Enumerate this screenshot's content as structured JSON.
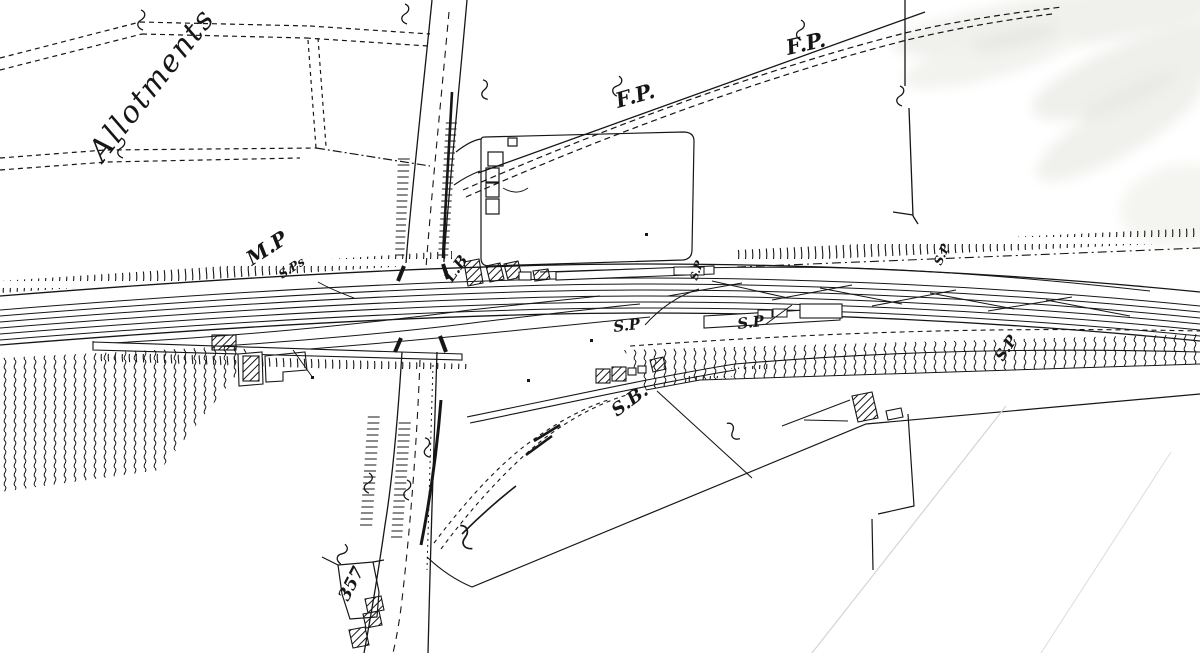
{
  "colors": {
    "ink": "#161616",
    "paper": "#ffffff",
    "faint_line": "#d4d4d0",
    "artifact_gray": "#ededea"
  },
  "labels": {
    "allotments": "Allotments",
    "footpath_west": "F.P.",
    "footpath_east": "F.P.",
    "milepost": "M.P",
    "milepost_sub": "S.Ps",
    "letter_box": "L.B",
    "signal_post_platform": "S.P",
    "signal_post_mid_west": "S.P",
    "signal_post_mid_east": "S.P",
    "signal_post_northeast": "S.P",
    "signal_post_southeast": "S.P",
    "signal_box": "S.B.",
    "parcel_number": "357"
  }
}
